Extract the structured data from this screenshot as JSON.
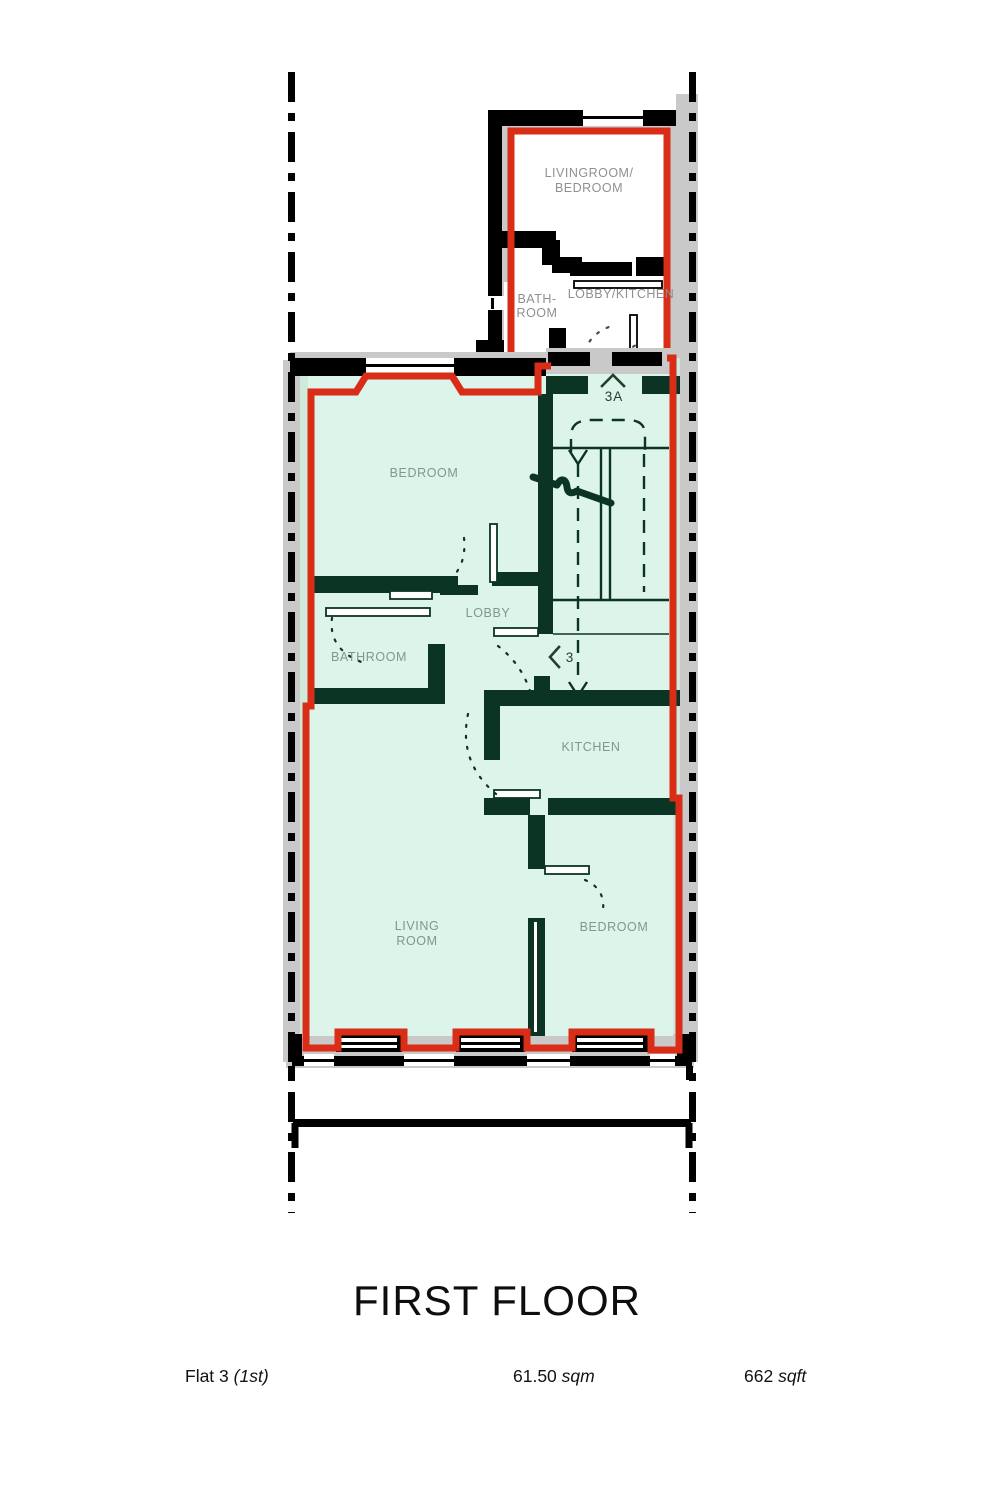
{
  "title": "FIRST FLOOR",
  "footer": {
    "flat_name": "Flat 3 ",
    "flat_suffix": "(1st)",
    "area_sqm_value": "61.50 ",
    "area_sqm_unit": "sqm",
    "area_sqft_value": "662 ",
    "area_sqft_unit": "sqft"
  },
  "upper_flat": {
    "livingroom_line1": "LIVINGROOM/",
    "livingroom_line2": "BEDROOM",
    "bathroom_line1": "BATH-",
    "bathroom_line2": "ROOM",
    "lobby_kitchen": "LOBBY/KITCHEN",
    "unit_label": "3A"
  },
  "main_flat": {
    "bedroom_top": "BEDROOM",
    "lobby": "LOBBY",
    "bathroom": "BATHROOM",
    "kitchen": "KITCHEN",
    "living_line1": "LIVING",
    "living_line2": "ROOM",
    "bedroom_bottom": "BEDROOM",
    "unit_label": "3"
  },
  "colors": {
    "red": "#d92d17",
    "mint": "#dcf4e9",
    "wallgreen": "#0c3424",
    "gray": "#c9c9c9",
    "pale": "#cfe9db"
  }
}
